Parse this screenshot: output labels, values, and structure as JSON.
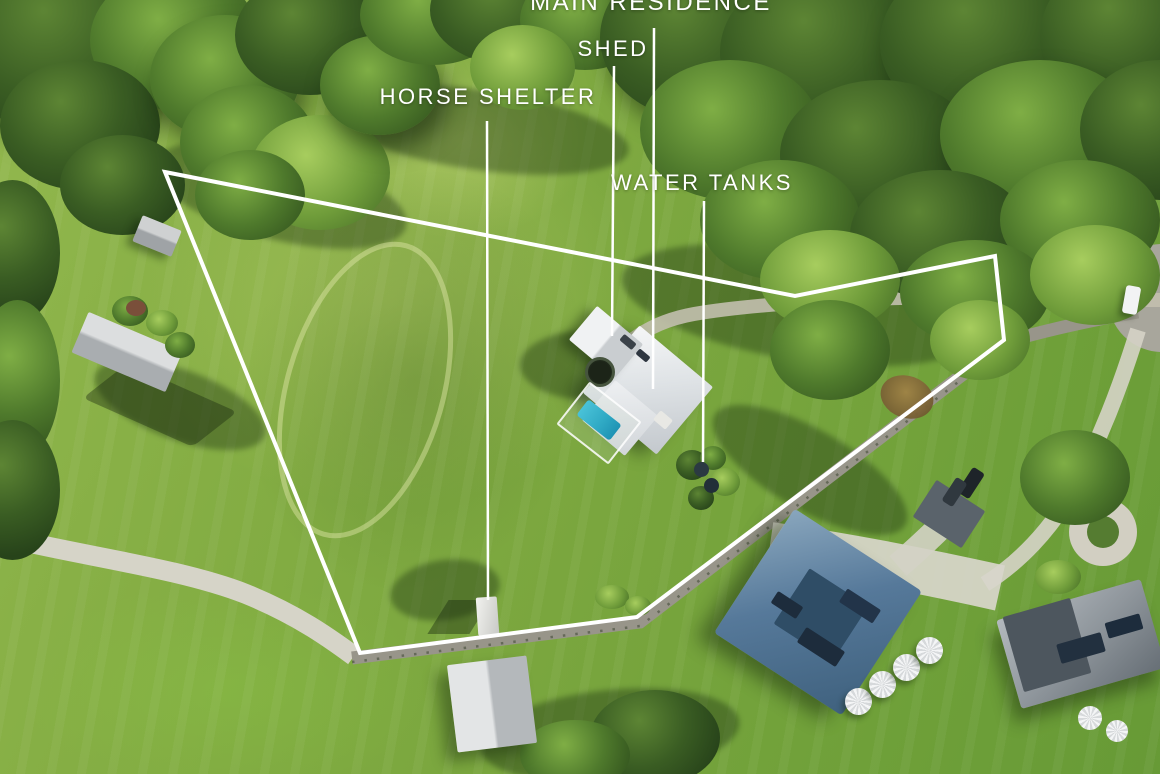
{
  "labels": {
    "main_residence": "MAIN RESIDENCE",
    "shed": "SHED",
    "horse_shelter": "HORSE SHELTER",
    "water_tanks": "WATER TANKS"
  },
  "colors": {
    "label-text": "#ffffff",
    "boundary": "#ffffff",
    "field-green": "#7aa63e",
    "forest-green": "#33511f",
    "road-concrete": "#d6d4c8",
    "road-asphalt": "#98958a",
    "roof-white": "#eef0f1",
    "roof-blue": "#56799a",
    "roof-grey": "#8f969c",
    "pool-blue": "#2fa9c4"
  }
}
